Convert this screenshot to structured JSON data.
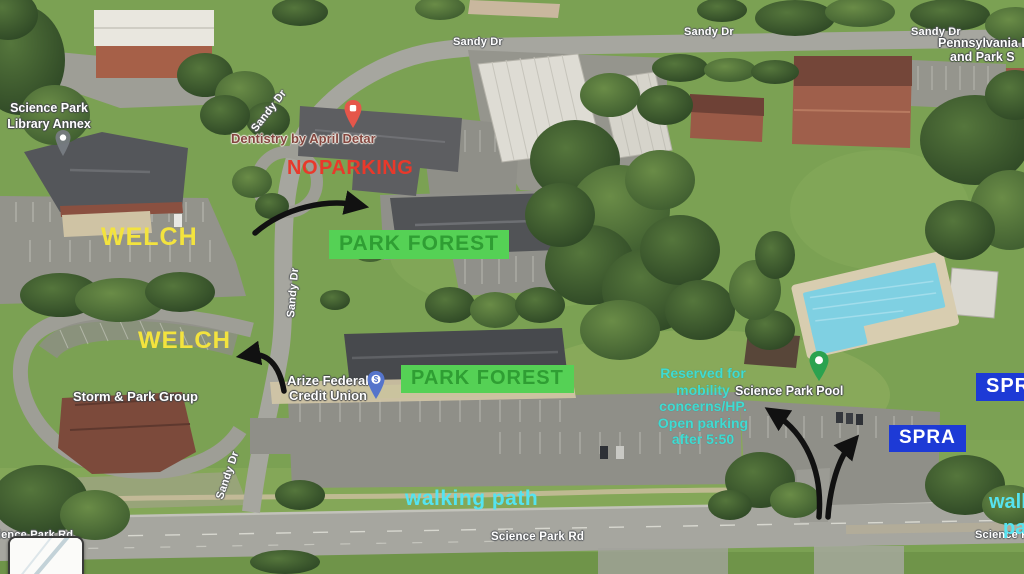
{
  "map": {
    "streets": {
      "sandy_top_center": "Sandy Dr",
      "sandy_top_mid_right": "Sandy Dr",
      "sandy_top_far_right": "Sandy Dr",
      "sandy_diag_upper": "Sandy Dr",
      "sandy_vertical": "Sandy Dr",
      "sandy_diag_lower": "Sandy Dr",
      "science_park_rd_center": "Science Park Rd",
      "science_park_rd_left": "Science Park Rd",
      "science_park_rd_right": "Science Park Rd"
    },
    "pois": {
      "library_line1": "Science Park",
      "library_line2": "Library Annex",
      "dentistry": "Dentistry by April Detar",
      "storm_park": "Storm & Park Group",
      "arize_line1": "Arize Federal",
      "arize_line2": "Credit Union",
      "pool": "Science Park Pool",
      "penn_line1": "Pennsylvania F",
      "penn_line2": "and Park S"
    },
    "icons": {
      "credit_union_symbol": "$"
    }
  },
  "annotations": {
    "no_parking": "NO PARKING",
    "welch_upper": "WELCH",
    "welch_lower": "WELCH",
    "park_forest_upper": "PARK FOREST",
    "park_forest_lower": "PARK FOREST",
    "spra_upper": "SPRA",
    "spra_lower": "SPRA",
    "reserved_note": [
      "Reserved for",
      "mobility",
      "concerns/HP.",
      "Open parking",
      "after 5:50"
    ],
    "walking_path": "walking path",
    "walking_path_edge_line1": "walking",
    "walking_path_edge_line2": "path"
  },
  "colors": {
    "no_parking": "#e8392b",
    "welch": "#f3e33e",
    "park_forest_bg": "#55d155",
    "park_forest_text": "#2f9e33",
    "spra_bg": "#1d3ad6",
    "spra_text": "#ffffff",
    "reserved_note": "#3fdbd2",
    "walking_path": "#55e3f0",
    "arrow": "#111111"
  }
}
